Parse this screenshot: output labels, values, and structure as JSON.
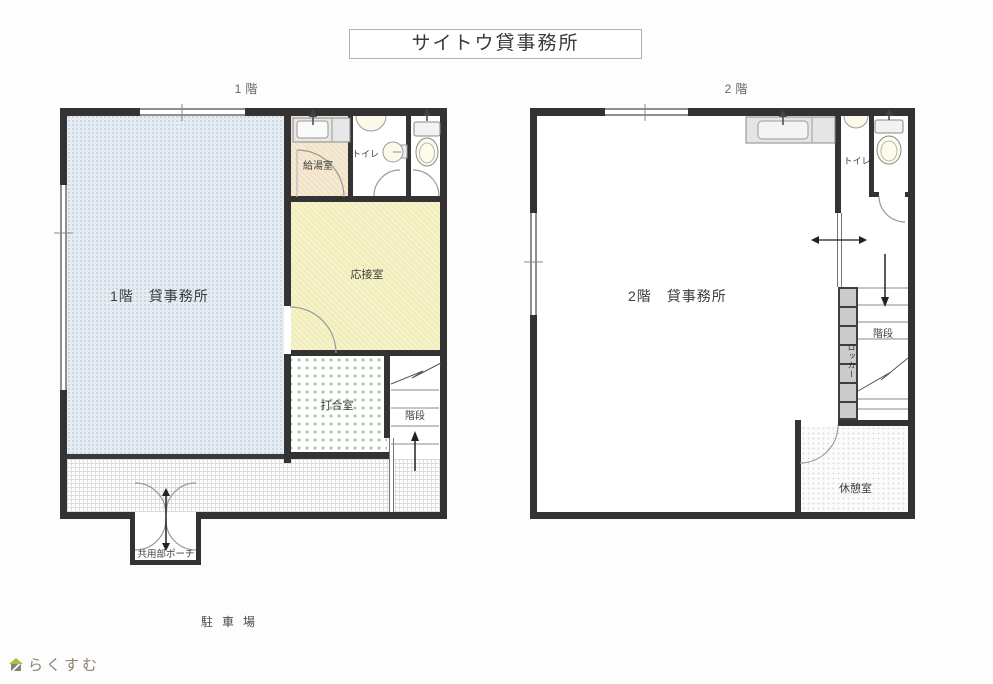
{
  "title": "サイトウ貸事務所",
  "floor1": {
    "label": "1階",
    "main_room": "1階　貸事務所",
    "kitchenette": "給湯室",
    "toilet": "トイレ",
    "reception": "応接室",
    "meeting_room": "打合室",
    "stairs": "階段",
    "porch": "共用部ポーチ",
    "parking": "駐車場"
  },
  "floor2": {
    "label": "2階",
    "main_room": "2階　貸事務所",
    "toilet": "トイレ",
    "stairs": "階段",
    "locker": "ロッカー",
    "break_room": "休憩室"
  },
  "logo": {
    "text": "らくすむ"
  },
  "colors": {
    "wall": "#333333",
    "office_blue": "#e6edf2",
    "kitchenette_beige": "#f2e2c8",
    "reception_yellow": "#f2eebb",
    "meeting_dot_green": "#a5cba5",
    "locker_gray": "#cbcbcb",
    "logo_green": "#a9bd4d",
    "logo_brown": "#8d8070"
  }
}
